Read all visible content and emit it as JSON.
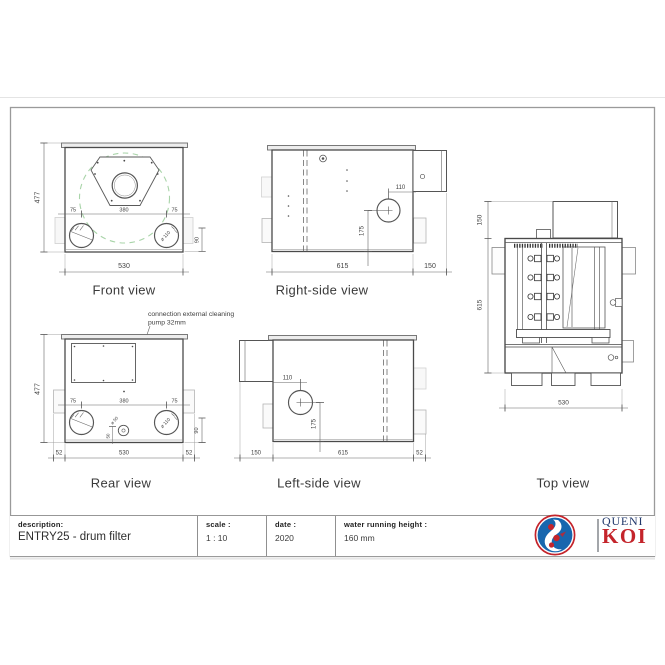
{
  "page": {
    "views": {
      "front": {
        "label": "Front view",
        "dim_height": "477",
        "dim_left": "75",
        "dim_center": "380",
        "dim_right": "75",
        "port_label": "ø 110",
        "dim_port_bottom": "90",
        "dim_width": "530"
      },
      "right_side": {
        "label": "Right-side view",
        "dim_port_top": "110",
        "dim_port_height": "175",
        "dim_length": "615",
        "dim_outlet": "150"
      },
      "top": {
        "label": "Top view",
        "dim_outlet": "150",
        "dim_length": "615",
        "dim_width": "530"
      },
      "rear": {
        "label": "Rear view",
        "annotation_line1": "connection external cleaning",
        "annotation_line2": "pump 32mm",
        "dim_height": "477",
        "dim_left": "75",
        "dim_center": "380",
        "dim_right": "75",
        "port_label": "ø 110",
        "drain_label": "ø 50",
        "dim_drain_offset": "50",
        "dim_port_bottom": "90",
        "dim_foot_left": "52",
        "dim_width": "530",
        "dim_foot_right": "52"
      },
      "left_side": {
        "label": "Left-side view",
        "dim_port_top": "110",
        "dim_port_height": "175",
        "dim_outlet": "150",
        "dim_length": "615",
        "dim_foot": "52"
      }
    },
    "title_block": {
      "description_label": "description:",
      "description_value": "ENTRY25 - drum filter",
      "scale_label": "scale :",
      "scale_value": "1 : 10",
      "date_label": "date :",
      "date_value": "2020",
      "water_label": "water running height :",
      "water_value": "160 mm"
    },
    "logo": {
      "name_top": "QUENI",
      "name_bottom": "KOI"
    },
    "colors": {
      "drawing_line": "#4a4a4a",
      "dimension_line": "#666666",
      "drum_dash_green": "#a9d4a9",
      "logo_navy": "#21386b",
      "logo_red": "#c4242b",
      "logo_blue": "#1766ae"
    }
  }
}
